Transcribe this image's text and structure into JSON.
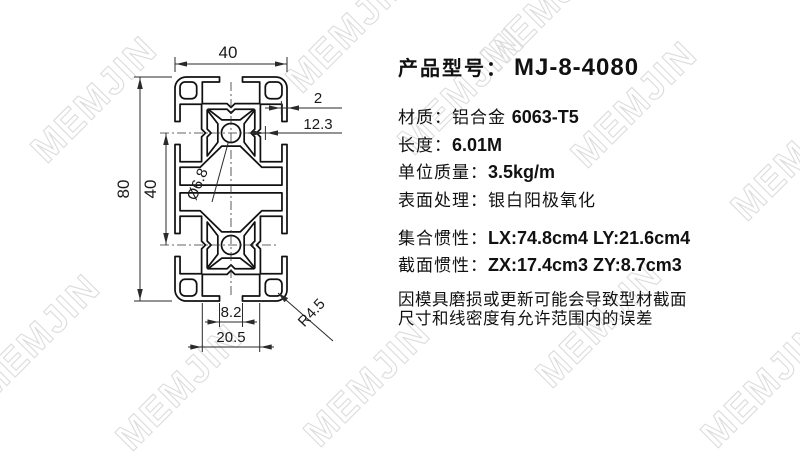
{
  "watermark": {
    "text": "MEMJIN",
    "color": "#dcdcdc"
  },
  "drawing": {
    "dims": {
      "top_width": "40",
      "overall_height": "80",
      "hole_spacing": "40",
      "wall_thickness": "2",
      "center_offset": "12.3",
      "hole_dia": "Ø6.8",
      "slot_opening": "8.2",
      "cavity_width": "20.5",
      "corner_radius": "R4.5"
    }
  },
  "panel": {
    "title": {
      "label": "产品型号：",
      "value": "MJ-8-4080"
    },
    "specs": [
      {
        "label": "材质：",
        "text": "铝合金 ",
        "bold": "6063-T5"
      },
      {
        "label": "长度：",
        "text": "",
        "bold": "6.01M"
      },
      {
        "label": "单位质量：",
        "text": "",
        "bold": "3.5kg/m"
      },
      {
        "label": "表面处理：",
        "text": "银白阳极氧化",
        "bold": ""
      }
    ],
    "inertia": [
      {
        "label": "集合惯性：",
        "bold": "LX:74.8cm4  LY:21.6cm4"
      },
      {
        "label": "截面惯性：",
        "bold": "ZX:17.4cm3  ZY:8.7cm3"
      }
    ],
    "notes": [
      "因模具磨损或更新可能会导致型材截面",
      "尺寸和线密度有允许范围内的误差"
    ]
  }
}
